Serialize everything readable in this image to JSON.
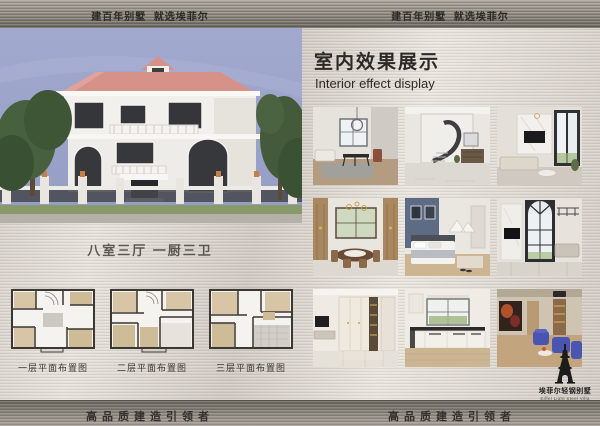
{
  "header": {
    "left": "建百年别墅  就选埃菲尔",
    "right": "建百年别墅  就选埃菲尔"
  },
  "left_panel": {
    "photo_label": "three-story-white-villa-exterior",
    "rooms_text": "八室三厅 一厨三卫",
    "floor_plans": [
      {
        "caption": "一层平面布置图"
      },
      {
        "caption": "二层平面布置图"
      },
      {
        "caption": "三层平面布置图"
      }
    ]
  },
  "right_panel": {
    "title": "室内效果展示",
    "subtitle": "Interior effect display",
    "gallery": [
      {
        "label": "living-dining-room"
      },
      {
        "label": "spiral-staircase-hall"
      },
      {
        "label": "double-height-living-room"
      },
      {
        "label": "wood-panel-dining-room"
      },
      {
        "label": "bedroom-blue-accent-wall"
      },
      {
        "label": "tall-arched-window-living-room"
      },
      {
        "label": "entry-wardrobe-hall"
      },
      {
        "label": "kitchen"
      },
      {
        "label": "home-theater-room"
      }
    ]
  },
  "footer": {
    "left": "高品质建造引领者",
    "right": "高品质建造引领者"
  },
  "logo": {
    "icon": "eiffel-tower-icon",
    "name": "埃菲尔轻钢别墅",
    "subtext": "Eiffel Light Steel Villa"
  },
  "colors": {
    "metal_light": "#d9d3cb",
    "metal_dark": "#6b665e",
    "sky": "#9aa1c8",
    "roof_pink": "#d69188",
    "text_dark": "#2c2a27"
  }
}
